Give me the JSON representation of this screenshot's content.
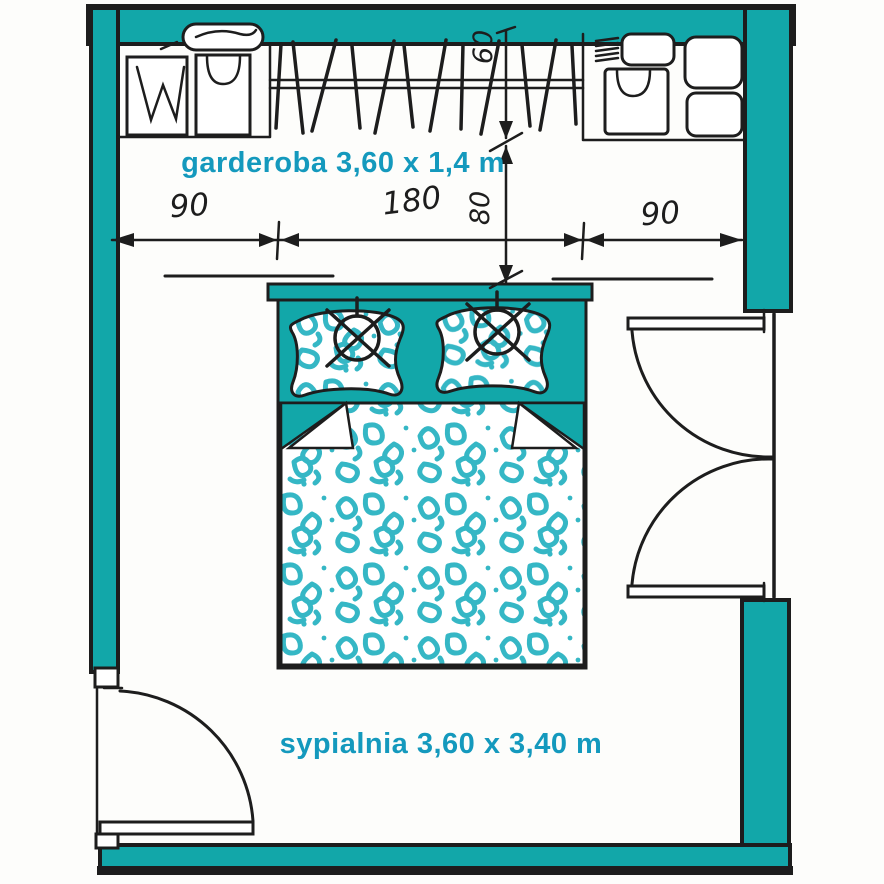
{
  "plan": {
    "room_labels": {
      "wardrobe": "garderoba 3,60 x 1,4 m",
      "bedroom": "sypialnia 3,60 x 3,40 m"
    },
    "dimensions_cm": {
      "top_left_segment": "90",
      "top_center_segment": "180",
      "top_right_segment": "90",
      "wardrobe_depth": "60",
      "wardrobe_clearance": "80"
    }
  },
  "colors": {
    "wall": "#12a7a9",
    "scribble": "#35b7c5",
    "label": "#1499bd",
    "line": "#1d1d1d"
  }
}
